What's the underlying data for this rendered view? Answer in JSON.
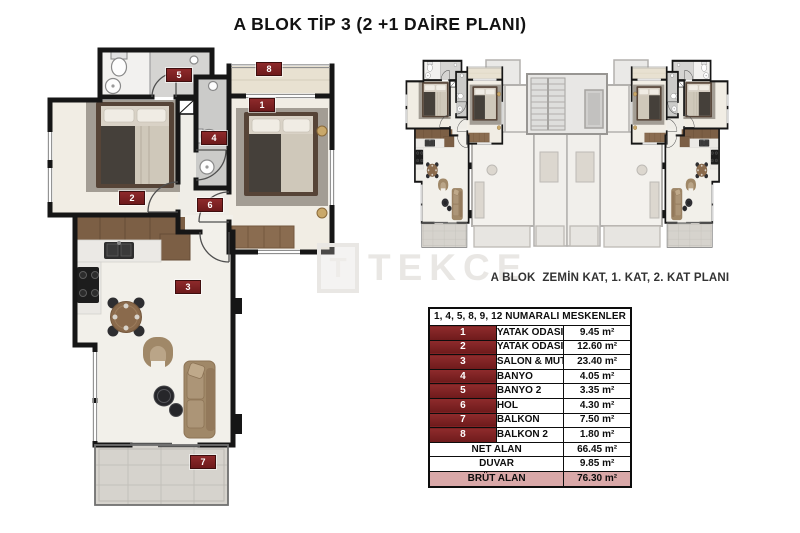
{
  "title": "A BLOK TİP 3 (2 +1 DAİRE PLANI)",
  "overview": {
    "caption": "A BLOK  ZEMİN KAT, 1. KAT, 2. KAT PLANI"
  },
  "watermark": {
    "logo_letter": "T",
    "brand": "TEKCE"
  },
  "floor_plan": {
    "badges": [
      "1",
      "2",
      "3",
      "4",
      "5",
      "6",
      "7",
      "8"
    ]
  },
  "table": {
    "header": "1, 4, 5, 8, 9, 12 NUMARALI MESKENLER",
    "rows": [
      {
        "num": "1",
        "name": "YATAK ODASI",
        "area": "9.45 m²"
      },
      {
        "num": "2",
        "name": "YATAK ODASI 2",
        "area": "12.60 m²"
      },
      {
        "num": "3",
        "name": "SALON & MUTFAK",
        "area": "23.40 m²"
      },
      {
        "num": "4",
        "name": "BANYO",
        "area": "4.05 m²"
      },
      {
        "num": "5",
        "name": "BANYO 2",
        "area": "3.35 m²"
      },
      {
        "num": "6",
        "name": "HOL",
        "area": "4.30 m²"
      },
      {
        "num": "7",
        "name": "BALKON",
        "area": "7.50 m²"
      },
      {
        "num": "8",
        "name": "BALKON 2",
        "area": "1.80 m²"
      }
    ],
    "summary": [
      {
        "name": "NET ALAN",
        "area": "66.45 m²"
      },
      {
        "name": "DUVAR",
        "area": "9.85 m²"
      },
      {
        "name": "BRÜT ALAN",
        "area": "76.30 m²"
      }
    ]
  },
  "colors": {
    "badge_red": "#7d1f1f",
    "highlight_pink": "#d9a8a8"
  }
}
